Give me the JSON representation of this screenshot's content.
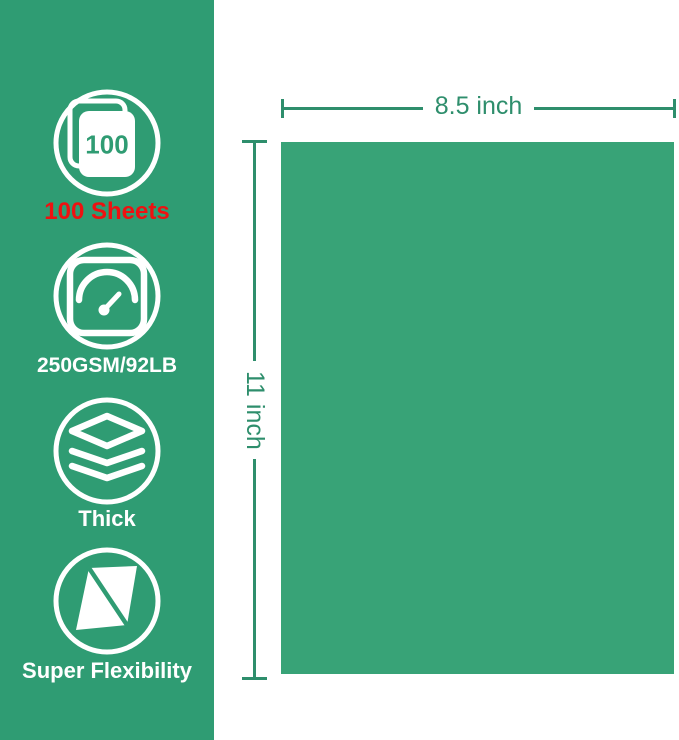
{
  "colors": {
    "banner_bg": "#2f9c73",
    "paper": "#38a377",
    "dimension": "#2e8e6c",
    "highlight_red": "#ee1111",
    "icon_white": "#ffffff"
  },
  "banner": {
    "features": [
      {
        "icon": "sheets-stack-icon",
        "badge": "100",
        "label": "100 Sheets"
      },
      {
        "icon": "gauge-icon",
        "label": "250GSM/92LB"
      },
      {
        "icon": "layers-icon",
        "label": "Thick"
      },
      {
        "icon": "flex-sheet-icon",
        "label": "Super Flexibility"
      }
    ]
  },
  "diagram": {
    "width_label": "8.5 inch",
    "height_label": "11 inch"
  }
}
